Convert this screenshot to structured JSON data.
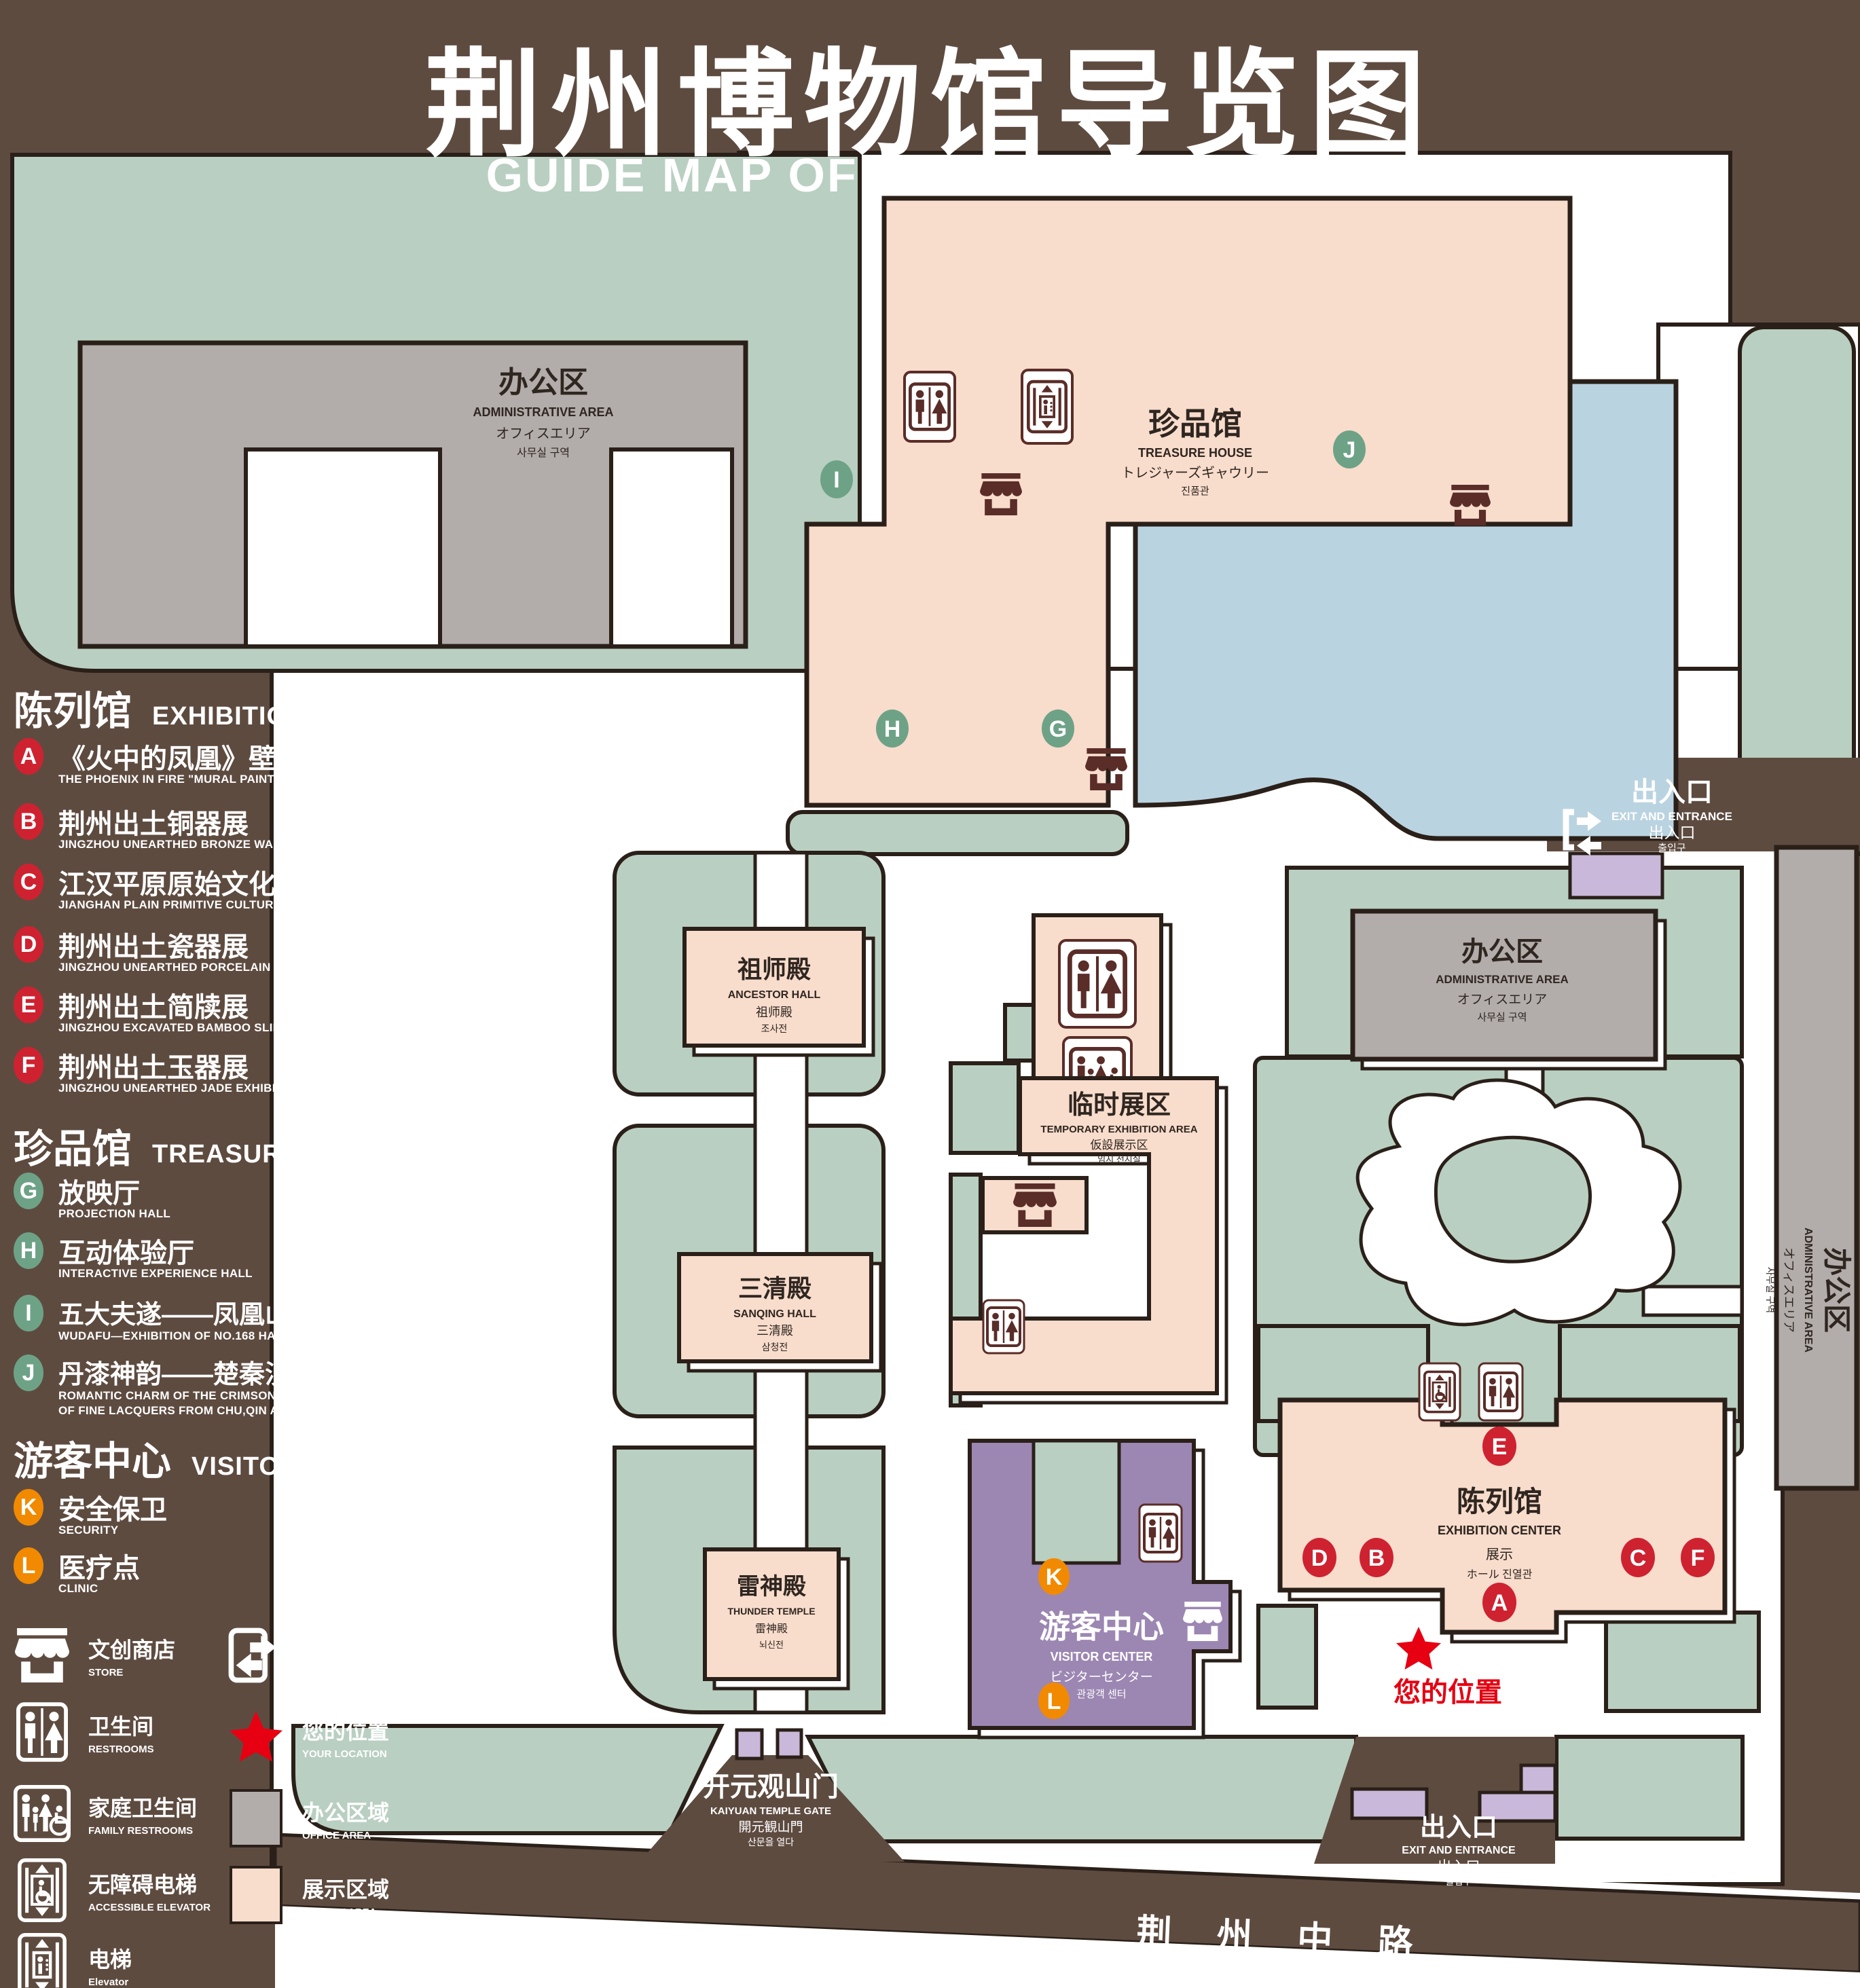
{
  "header": {
    "title": "荆州博物馆导览图",
    "subtitle": "GUIDE MAP OF JINGZHOU MUSEUM"
  },
  "colors": {
    "background": "#5e4b40",
    "green": "#b9cfc1",
    "pink": "#f8dccc",
    "gray": "#b2acaa",
    "blue": "#bad3e1",
    "purple": "#9c86b2",
    "lavender": "#cab8da",
    "outline": "#2a2019",
    "badge_red": "#ce2231",
    "badge_green": "#6ea287",
    "badge_orange": "#f18a00",
    "accent_red": "#e60012"
  },
  "legend": {
    "sections": [
      {
        "id": "exhibition-center",
        "zh": "陈列馆",
        "en": "EXHIBITION CENTER",
        "items": [
          {
            "id": "A",
            "zh": "《火中的凤凰》壁画",
            "en": "THE PHOENIX IN FIRE \"MURAL PAINTING",
            "floor": "1F"
          },
          {
            "id": "B",
            "zh": "荆州出土铜器展",
            "en": "JINGZHOU UNEARTHED BRONZE WARE EXHIBITION",
            "floor": "1F"
          },
          {
            "id": "C",
            "zh": "江汉平原原始文化展",
            "en": "JIANGHAN PLAIN PRIMITIVE CULTURE EXHIBITION",
            "floor": "1F"
          },
          {
            "id": "D",
            "zh": "荆州出土瓷器展",
            "en": "JINGZHOU UNEARTHED PORCELAIN EXHIBITIONE",
            "floor": "2F"
          },
          {
            "id": "E",
            "zh": "荆州出土简牍展",
            "en": "JINGZHOU EXCAVATED BAMBOO SLIPS EXHIBITION",
            "floor": "2F"
          },
          {
            "id": "F",
            "zh": "荆州出土玉器展",
            "en": "JINGZHOU UNEARTHED JADE EXHIBITION",
            "floor": "2F"
          }
        ]
      },
      {
        "id": "treasure-house",
        "zh": "珍品馆",
        "en": "TREASURE HOUSE",
        "items": [
          {
            "id": "G",
            "zh": "放映厅",
            "en": "PROJECTION HALL",
            "floor": "1F"
          },
          {
            "id": "H",
            "zh": "互动体验厅",
            "en": "INTERACTIVE EXPERIENCE HALL",
            "floor": "1F"
          },
          {
            "id": "I",
            "zh": "五大夫遂——凤凰山168号汉墓展",
            "en": "WUDAFU—EXHIBITION OF NO.168 HAN TOMB FROM FENGHUANGSHAN",
            "floor": "2F"
          },
          {
            "id": "J",
            "zh": "丹漆神韵——楚秦汉漆器精品展",
            "en": "ROMANTIC CHARM OF THE CRIMSON LACQUERS—EXHIBITIONS OF FINE LACQUERS FROM CHU,QIN AND HAN DYNASTIES",
            "floor": "1-2F"
          }
        ]
      },
      {
        "id": "visitor-center",
        "zh": "游客中心",
        "en": "VISITOR CENTER",
        "items": [
          {
            "id": "K",
            "zh": "安全保卫",
            "en": "SECURITY",
            "floor": "1F"
          },
          {
            "id": "L",
            "zh": "医疗点",
            "en": "CLINIC",
            "floor": "1F"
          }
        ]
      }
    ],
    "icons_left": [
      {
        "icon": "store-icon",
        "zh": "文创商店",
        "en": "STORE"
      },
      {
        "icon": "restroom-icon",
        "zh": "卫生间",
        "en": "RESTROOMS"
      },
      {
        "icon": "family-restroom-icon",
        "zh": "家庭卫生间",
        "en": "FAMILY RESTROOMS"
      },
      {
        "icon": "accessible-elevator-icon",
        "zh": "无障碍电梯",
        "en": "ACCESSIBLE ELEVATOR"
      },
      {
        "icon": "elevator-icon",
        "zh": "电梯",
        "en": "Elevator"
      }
    ],
    "icons_right": [
      {
        "icon": "exit-icon",
        "zh": "出入口",
        "en": "EXIT AND ENTRANCE"
      },
      {
        "icon": "location-star",
        "zh": "您的位置",
        "en": "YOUR LOCATION"
      },
      {
        "icon": "office-swatch",
        "zh": "办公区域",
        "en": "OFFICE AREA"
      },
      {
        "icon": "display-swatch",
        "zh": "展示区域",
        "en": "DISPLAY AREA"
      }
    ]
  },
  "map": {
    "admin": {
      "zh": "办公区",
      "en": "ADMINISTRATIVE AREA",
      "l3": "オフィスエリア",
      "l4": "사무실 구역"
    },
    "treasure": {
      "zh": "珍品馆",
      "en": "TREASURE HOUSE",
      "l3": "トレジャーズギャウリー",
      "l4": "진품관"
    },
    "ancestor": {
      "zh": "祖师殿",
      "en": "ANCESTOR HALL",
      "l3": "祖师殿",
      "l4": "조사전"
    },
    "temporary": {
      "zh": "临时展区",
      "en": "TEMPORARY EXHIBITION AREA",
      "l3": "仮設展示区",
      "l4": "임시 전시실"
    },
    "sanqing": {
      "zh": "三清殿",
      "en": "SANQING HALL",
      "l3": "三清殿",
      "l4": "삼청전"
    },
    "thunder": {
      "zh": "雷神殿",
      "en": "THUNDER TEMPLE",
      "l3": "雷神殿",
      "l4": "뇌신전"
    },
    "visitor": {
      "zh": "游客中心",
      "en": "VISITOR CENTER",
      "l3": "ビジターセンター",
      "l4": "관광객 센터"
    },
    "exhibition": {
      "zh": "陈列馆",
      "en": "EXHIBITION CENTER",
      "l3": "展示",
      "l4": "ホール 진열관"
    },
    "exit": {
      "zh": "出入口",
      "en": "EXIT AND ENTRANCE",
      "l3": "出入口",
      "l4": "출입구"
    },
    "gate": {
      "zh": "开元观山门",
      "en": "KAIYUAN TEMPLE GATE",
      "l3": "開元観山門",
      "l4": "산문을 열다"
    },
    "your_location": "您的位置",
    "road": "荆 州 中 路",
    "badges": {
      "A": "A",
      "B": "B",
      "C": "C",
      "D": "D",
      "E": "E",
      "F": "F",
      "G": "G",
      "H": "H",
      "I": "I",
      "J": "J",
      "K": "K",
      "L": "L"
    }
  }
}
